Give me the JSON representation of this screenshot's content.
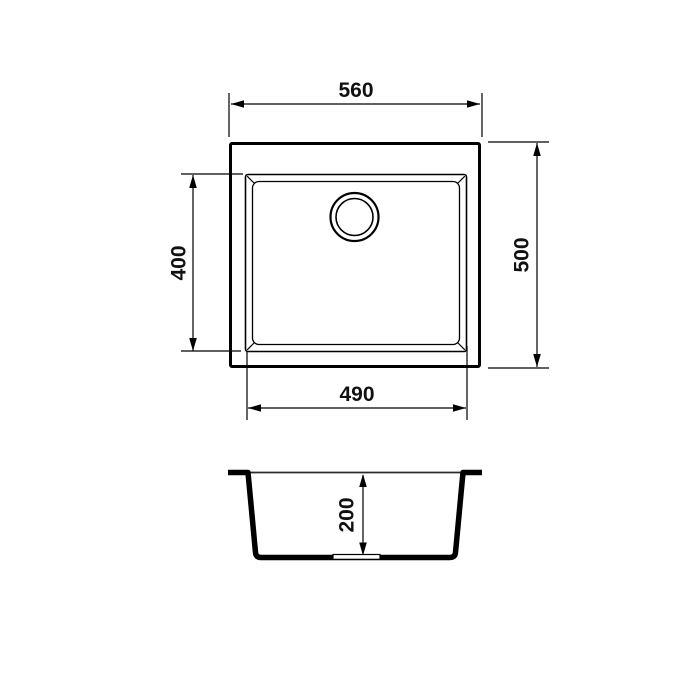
{
  "page": {
    "background": "#ffffff",
    "line_color": "#000000"
  },
  "drawing": {
    "type": "technical-dimension-drawing",
    "subject": "single-bowl-sink",
    "dims": {
      "overall_width": "560",
      "overall_depth": "500",
      "bowl_depth": "400",
      "bowl_width": "490",
      "bowl_height": "200"
    }
  }
}
